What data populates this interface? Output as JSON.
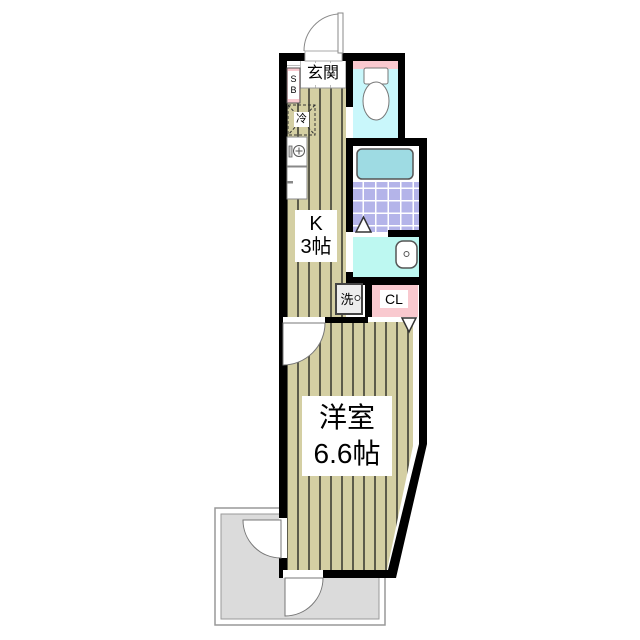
{
  "labels": {
    "entrance": "玄関",
    "shoe_box": "SB",
    "refrigerator": "冷",
    "kitchen_name": "K",
    "kitchen_size": "3帖",
    "washer": "洗",
    "closet": "CL",
    "main_room_name": "洋室",
    "main_room_size": "6.6帖"
  },
  "colors": {
    "wall": "#000000",
    "floor_beige": "#d4cfa3",
    "floor_stripe": "#5c5b4a",
    "pink": "#f9c9cf",
    "toilet_floor": "#c9f7fb",
    "bathtub": "#9edbe3",
    "bath_tile": "#b4b4e9",
    "wash_floor": "#bdf8f1",
    "balcony": "#dbdbdb",
    "door_line": "#888888"
  }
}
